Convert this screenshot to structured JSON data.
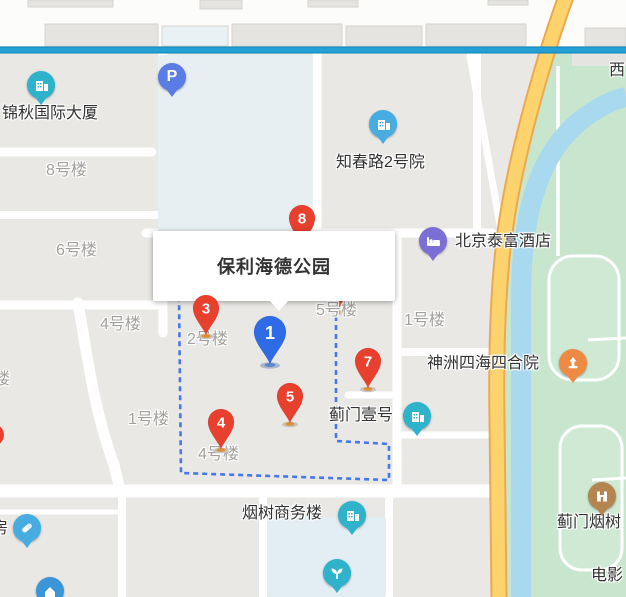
{
  "infobox": {
    "title": "保利海德公园"
  },
  "pins": [
    {
      "label": "1"
    },
    {
      "label": "3"
    },
    {
      "label": "4"
    },
    {
      "label": "5"
    },
    {
      "label": "7"
    },
    {
      "label": "8"
    }
  ],
  "parking": {
    "glyph": "P"
  },
  "poi_labels": [
    {
      "text": "锦秋国际大厦"
    },
    {
      "text": "知春路2号院"
    },
    {
      "text": "北京泰富酒店"
    },
    {
      "text": "神洲四海四合院"
    },
    {
      "text": "蓟门壹号"
    },
    {
      "text": "烟树商务楼"
    },
    {
      "text": "蓟门烟树"
    },
    {
      "text": "电影"
    },
    {
      "text": "房"
    },
    {
      "text": "西"
    }
  ],
  "building_labels": [
    {
      "text": "8号楼"
    },
    {
      "text": "6号楼"
    },
    {
      "text": "4号楼"
    },
    {
      "text": "2号楼"
    },
    {
      "text": "5号楼"
    },
    {
      "text": "1号楼"
    },
    {
      "text": "1号楼"
    },
    {
      "text": "4号楼"
    },
    {
      "text": "楼"
    }
  ],
  "colors": {
    "red_pin": "#e8402f",
    "blue_pin": "#2e6be5",
    "boundary_dash": "#4678e8",
    "road_blue": "#1d9ccf",
    "road_yellow": "#fcd36d",
    "river": "#a8d9ef",
    "park_green": "#c8e6ce",
    "poi_teal": "#2eb3ca",
    "poi_blue": "#47ade0",
    "poi_purple": "#7b6fd6",
    "poi_orange": "#ef8a45",
    "poi_brown": "#b5854f",
    "poi_parking": "#5b7ce4"
  }
}
